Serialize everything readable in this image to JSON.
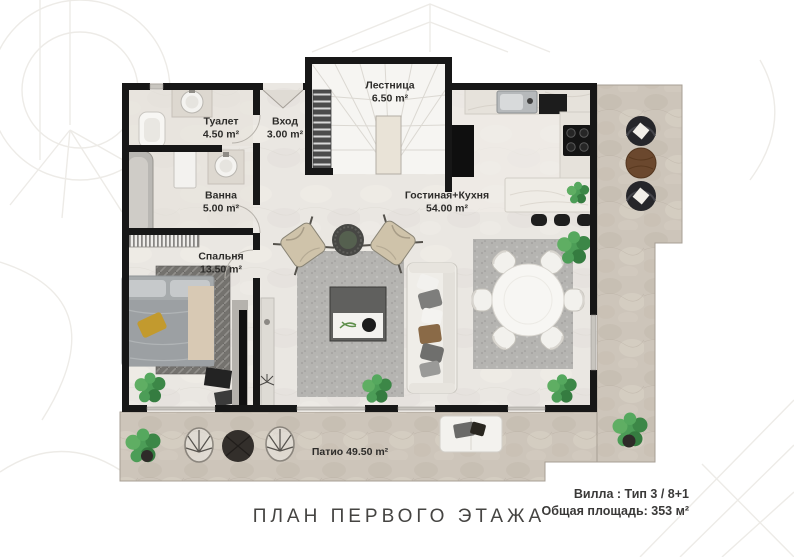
{
  "footer": {
    "plan_title": "ПЛАН ПЕРВОГО ЭТАЖА",
    "villa_type": "Вилла : Тип 3 / 8+1",
    "total_area": "Общая площадь: 353 м²"
  },
  "rooms": [
    {
      "name": "Туалет",
      "area": "4.50 m²"
    },
    {
      "name": "Вход",
      "area": "3.00 m²"
    },
    {
      "name": "Лестница",
      "area": "6.50 m²"
    },
    {
      "name": "Ванна",
      "area": "5.00 m²"
    },
    {
      "name": "Гостиная+Кухня",
      "area": "54.00 m²"
    },
    {
      "name": "Спальня",
      "area": "13.50 m²"
    },
    {
      "name": "Патио",
      "area": "49.50 m²",
      "label": "Патио 49.50 m²"
    }
  ],
  "colors": {
    "wall": "#171717",
    "floor": "#eae7e2",
    "stone": "#cdc5ba",
    "rug": "#b5b4b1",
    "green": "#4c9d57",
    "wood": "#6b482e",
    "accent": "#c29a2e"
  }
}
